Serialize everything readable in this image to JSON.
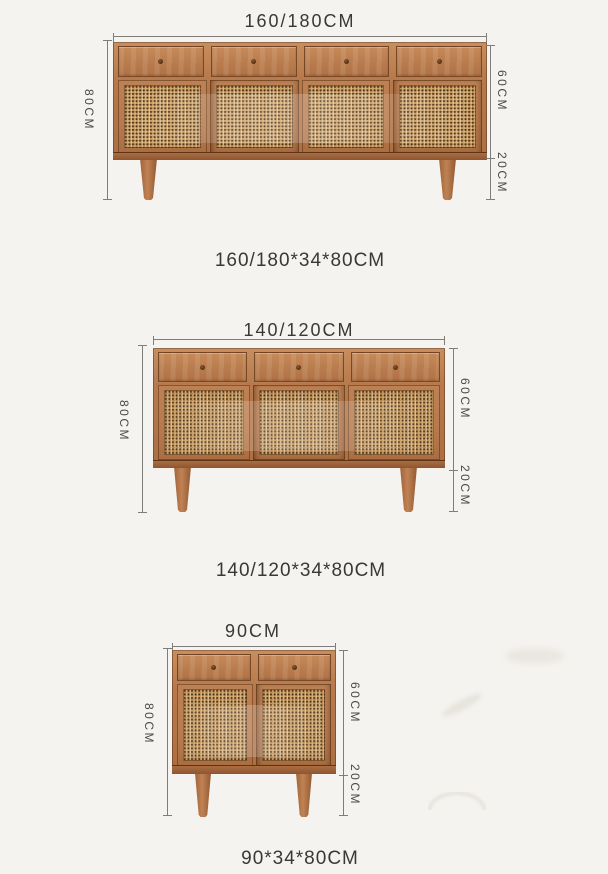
{
  "colors": {
    "wood": "#b87a4c",
    "wood_light": "#c98e5e",
    "wood_dark": "#8e5731",
    "rattan": "#d3a76c",
    "rattan_dot": "#4a2e12",
    "dimension_line": "#7f7d7a",
    "text": "#3a3836",
    "background": "#f5f3ef"
  },
  "figures": [
    {
      "name": "large-sideboard",
      "width_label": "160/180CM",
      "height_label": "80CM",
      "body_height_label": "60CM",
      "leg_height_label": "20CM",
      "caption": "160/180*34*80CM",
      "drawer_count": 4,
      "door_count": 4
    },
    {
      "name": "medium-sideboard",
      "width_label": "140/120CM",
      "height_label": "80CM",
      "body_height_label": "60CM",
      "leg_height_label": "20CM",
      "caption": "140/120*34*80CM",
      "drawer_count": 3,
      "door_count": 3
    },
    {
      "name": "small-sideboard",
      "width_label": "90CM",
      "height_label": "80CM",
      "body_height_label": "60CM",
      "leg_height_label": "20CM",
      "caption": "90*34*80CM",
      "drawer_count": 2,
      "door_count": 2
    }
  ]
}
